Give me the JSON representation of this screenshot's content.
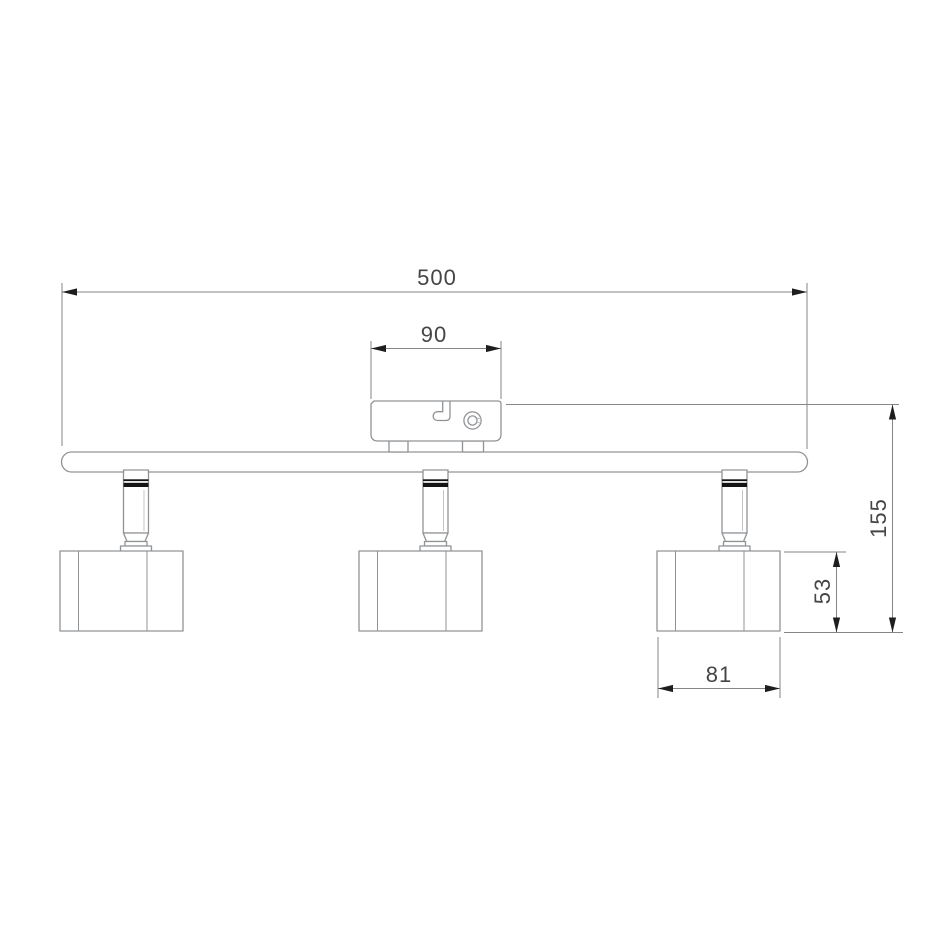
{
  "dimensions": {
    "overall_width": "500",
    "canopy_width": "90",
    "overall_height": "155",
    "head_height": "53",
    "head_width": "81"
  },
  "colors": {
    "background": "#ffffff",
    "outline": "#909396",
    "dimension_line": "#868686",
    "arrow": "#1e1e1e",
    "text": "#454545",
    "stem_band": "#141414"
  }
}
